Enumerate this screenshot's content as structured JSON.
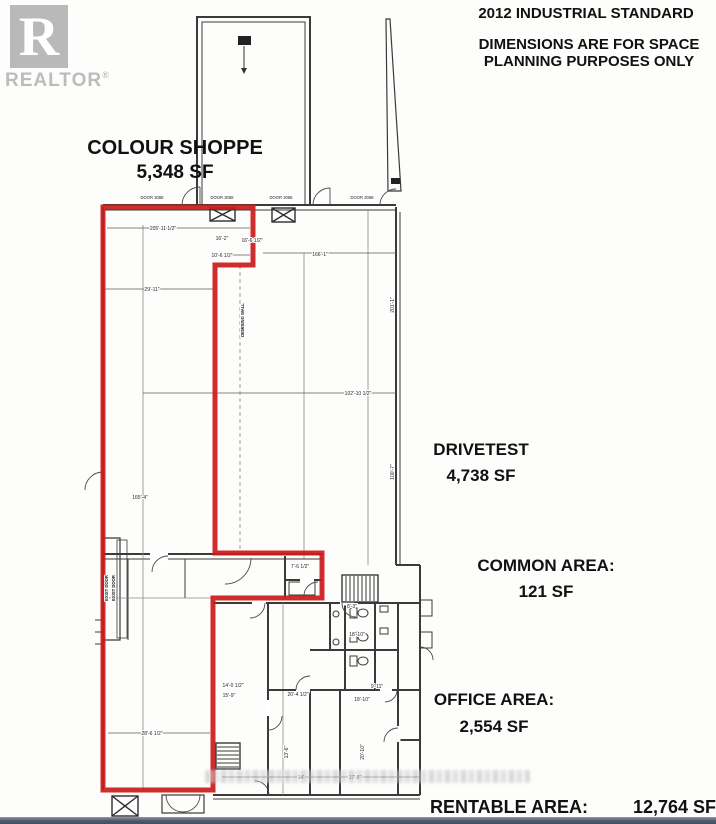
{
  "logo": {
    "letter": "R",
    "brand": "REALTOR",
    "registered": "®"
  },
  "header": {
    "line1": "2012 INDUSTRIAL STANDARD",
    "line2": "DIMENSIONS ARE FOR SPACE",
    "line3": "PLANNING PURPOSES ONLY"
  },
  "areas": {
    "colour_shoppe": {
      "name": "COLOUR SHOPPE",
      "size": "5,348 SF"
    },
    "drivetest": {
      "name": "DRIVETEST",
      "size": "4,738 SF"
    },
    "common": {
      "name": "COMMON AREA:",
      "size": "121 SF"
    },
    "office": {
      "name": "OFFICE AREA:",
      "size": "2,554 SF"
    },
    "rentable": {
      "name": "RENTABLE AREA:",
      "size": "12,764 SF"
    }
  },
  "colors": {
    "highlight_outline": "#cb1d1d",
    "plan_line": "#3a3a3a",
    "grid_line": "#888888",
    "logo_gray": "#b9b9b9",
    "footer_bar": "#4a596c"
  },
  "plan": {
    "dimensions": [
      {
        "t": "205'-11 1/2\"",
        "x": 163,
        "y": 230,
        "r": 0
      },
      {
        "t": "16'-2\"",
        "x": 222,
        "y": 240,
        "r": 0
      },
      {
        "t": "16'-6 1/2\"",
        "x": 252,
        "y": 242,
        "r": 0
      },
      {
        "t": "10'-6 1/2\"",
        "x": 222,
        "y": 257,
        "r": 0
      },
      {
        "t": "166'-1\"",
        "x": 320,
        "y": 256,
        "r": 0
      },
      {
        "t": "29'-11\"",
        "x": 152,
        "y": 291,
        "r": 0
      },
      {
        "t": "102'-10 1/2\"",
        "x": 358,
        "y": 395,
        "r": 0
      },
      {
        "t": "165'-4\"",
        "x": 140,
        "y": 499,
        "r": 0
      },
      {
        "t": "28'-6 1/2\"",
        "x": 152,
        "y": 735,
        "r": 0
      },
      {
        "t": "7'-6 1/2\"",
        "x": 300,
        "y": 568,
        "r": 0
      },
      {
        "t": "8'-3\"",
        "x": 352,
        "y": 608,
        "r": 0
      },
      {
        "t": "18'-10\"",
        "x": 357,
        "y": 636,
        "r": 0
      },
      {
        "t": "14'-0 1/2\"",
        "x": 233,
        "y": 687,
        "r": 0
      },
      {
        "t": "15'-9\"",
        "x": 229,
        "y": 697,
        "r": 0
      },
      {
        "t": "20'-4 1/2\"",
        "x": 298,
        "y": 696,
        "r": 0
      },
      {
        "t": "9'-11\"",
        "x": 377,
        "y": 688,
        "r": 0
      },
      {
        "t": "18'-10\"",
        "x": 362,
        "y": 701,
        "r": 0
      },
      {
        "t": "13'-6\"",
        "x": 288,
        "y": 752,
        "r": -90
      },
      {
        "t": "20'-10\"",
        "x": 364,
        "y": 752,
        "r": -90
      },
      {
        "t": "14'",
        "x": 301,
        "y": 779,
        "r": 0
      },
      {
        "t": "17'-8\"",
        "x": 355,
        "y": 779,
        "r": 0
      },
      {
        "t": "201'-1\"",
        "x": 394,
        "y": 305,
        "r": -90
      },
      {
        "t": "100'-7\"",
        "x": 394,
        "y": 472,
        "r": -90
      }
    ],
    "door_labels": [
      {
        "t": "DOOR 3068",
        "x": 152,
        "y": 199
      },
      {
        "t": "DOOR 3068",
        "x": 222,
        "y": 199
      },
      {
        "t": "DOOR 3068",
        "x": 281,
        "y": 199
      },
      {
        "t": "DOOR 3068",
        "x": 362,
        "y": 199
      }
    ],
    "notes": [
      {
        "t": "DEMISING WALL",
        "x": 244,
        "y": 320,
        "r": -90
      },
      {
        "t": "EXIST DOOR",
        "x": 108,
        "y": 588,
        "r": -90
      },
      {
        "t": "EXIST DOOR",
        "x": 115,
        "y": 588,
        "r": -90
      }
    ]
  }
}
